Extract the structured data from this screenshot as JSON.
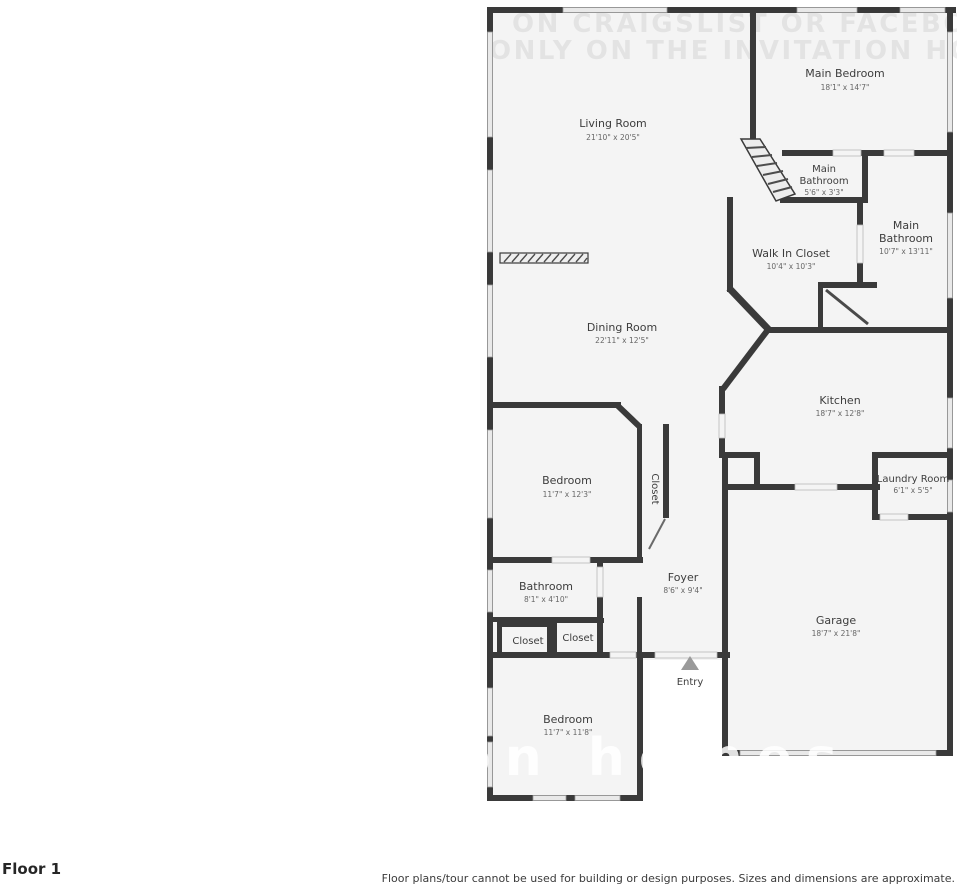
{
  "watermark": {
    "top_line1": "ON CRAIGSLIST OR FACEBOOK MAR",
    "top_line2": "ONLY ON THE INVITATION HOMES WE",
    "bottom_fragment": "on homes"
  },
  "footer": {
    "floor_label": "Floor 1",
    "disclaimer": "Floor plans/tour cannot be used for building or design purposes. Sizes and dimensions are approximate."
  },
  "colors": {
    "wall": "#3a3a3a",
    "floor_fill": "#f4f4f4",
    "window_fill": "#e9e9e9"
  },
  "rooms": {
    "living_room": {
      "name": "Living Room",
      "dims": "21'10\" x 20'5\""
    },
    "main_bedroom": {
      "name": "Main Bedroom",
      "dims": "18'1\" x 14'7\""
    },
    "main_bathroom_small": {
      "line1": "Main",
      "line2": "Bathroom",
      "dims": "5'6\" x 3'3\""
    },
    "main_bathroom": {
      "line1": "Main",
      "line2": "Bathroom",
      "dims": "10'7\" x 13'11\""
    },
    "walk_in_closet": {
      "name": "Walk In Closet",
      "dims": "10'4\" x 10'3\""
    },
    "dining_room": {
      "name": "Dining Room",
      "dims": "22'11\" x 12'5\""
    },
    "kitchen": {
      "name": "Kitchen",
      "dims": "18'7\" x 12'8\""
    },
    "bedroom_mid": {
      "name": "Bedroom",
      "dims": "11'7\" x 12'3\""
    },
    "closet_hall": {
      "name": "Closet"
    },
    "laundry_room": {
      "name": "Laundry Room",
      "dims": "6'1\" x 5'5\""
    },
    "bathroom": {
      "name": "Bathroom",
      "dims": "8'1\" x 4'10\""
    },
    "closet_left": {
      "name": "Closet"
    },
    "closet_right": {
      "name": "Closet"
    },
    "foyer": {
      "name": "Foyer",
      "dims": "8'6\" x 9'4\""
    },
    "entry": {
      "name": "Entry"
    },
    "garage": {
      "name": "Garage",
      "dims": "18'7\" x 21'8\""
    },
    "bedroom_bottom": {
      "name": "Bedroom",
      "dims": "11'7\" x 11'8\""
    }
  }
}
